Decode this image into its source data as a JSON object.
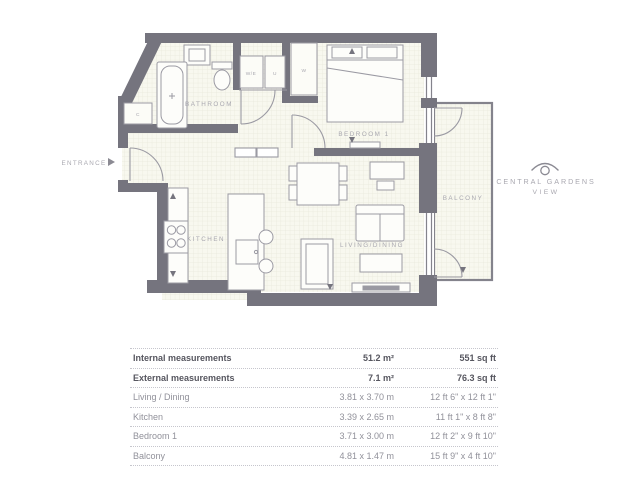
{
  "plan": {
    "entrance_label": "ENTRANCE",
    "rooms": {
      "bathroom": "BATHROOM",
      "bedroom1": "BEDROOM 1",
      "kitchen": "KITCHEN",
      "living": "LIVING/DINING",
      "balcony": "BALCONY"
    },
    "closets": {
      "washer": "W/E",
      "utility": "U",
      "wardrobe": "W",
      "cupboard": "C"
    },
    "colors": {
      "wall": "#75747e",
      "floor": "#f8f8ef",
      "floor_grid": "#e9e9da",
      "fixture_stroke": "#9b9aa3",
      "label_text": "#a9a8b0"
    }
  },
  "logo": {
    "line1": "CENTRAL GARDENS",
    "line2": "VIEW"
  },
  "table": {
    "summary_rows": [
      {
        "label": "Internal measurements",
        "metric": "51.2 m²",
        "imperial": "551 sq ft"
      },
      {
        "label": "External measurements",
        "metric": "7.1 m²",
        "imperial": "76.3 sq ft"
      }
    ],
    "rooms": [
      {
        "label": "Living / Dining",
        "metric": "3.81 x 3.70 m",
        "imperial": "12 ft 6\" x 12 ft 1\""
      },
      {
        "label": "Kitchen",
        "metric": "3.39 x 2.65 m",
        "imperial": "11 ft 1\" x 8 ft 8\""
      },
      {
        "label": "Bedroom 1",
        "metric": "3.71 x 3.00 m",
        "imperial": "12 ft 2\" x 9 ft 10\""
      },
      {
        "label": "Balcony",
        "metric": "4.81 x 1.47 m",
        "imperial": "15 ft 9\" x 4 ft 10\""
      }
    ]
  }
}
